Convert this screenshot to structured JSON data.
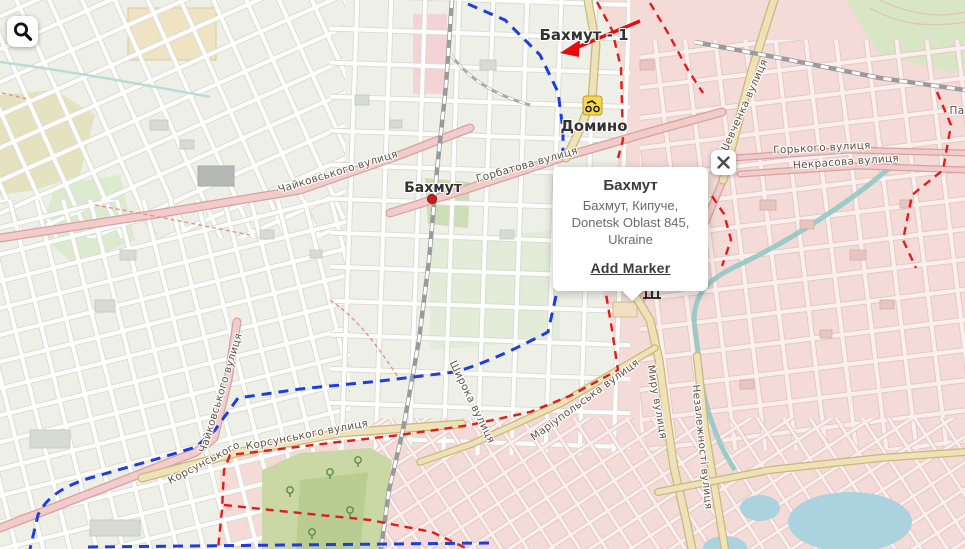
{
  "ui": {
    "search_button": {
      "icon": "magnifier"
    },
    "close_button": {
      "icon": "x"
    },
    "popup": {
      "title": "Бахмут",
      "address_lines": [
        "Бахмут, Кипуче,",
        "Donetsk Oblast 845,",
        "Ukraine"
      ],
      "action_label": "Add Marker"
    }
  },
  "map": {
    "labels": [
      {
        "kind": "place",
        "text": "Бахмут - 1",
        "x": 584,
        "y": 35,
        "rot": 0,
        "size": 15
      },
      {
        "kind": "place",
        "text": "Домино",
        "x": 594,
        "y": 126,
        "rot": 0,
        "size": 15
      },
      {
        "kind": "place",
        "text": "Бахмут",
        "x": 433,
        "y": 188,
        "rot": 0,
        "size": 14
      },
      {
        "kind": "street",
        "text": "Чайковського вулиця",
        "x": 338,
        "y": 172,
        "rot": -17
      },
      {
        "kind": "street",
        "text": "Горбатова вулиця",
        "x": 527,
        "y": 165,
        "rot": -16
      },
      {
        "kind": "street",
        "text": "Чайковського вулиця",
        "x": 221,
        "y": 393,
        "rot": -73
      },
      {
        "kind": "street",
        "text": "Корсунського вулиця",
        "x": 307,
        "y": 435,
        "rot": -11
      },
      {
        "kind": "street",
        "text": "Корсунського",
        "x": 204,
        "y": 463,
        "rot": -28
      },
      {
        "kind": "street",
        "text": "Широка вулиця",
        "x": 472,
        "y": 402,
        "rot": 64
      },
      {
        "kind": "street",
        "text": "Маріупольська вулиця",
        "x": 585,
        "y": 400,
        "rot": -36
      },
      {
        "kind": "street",
        "text": "Миру вулиця",
        "x": 657,
        "y": 402,
        "rot": 80
      },
      {
        "kind": "street",
        "text": "Незалежності вулиця",
        "x": 702,
        "y": 447,
        "rot": 84
      },
      {
        "kind": "street",
        "text": "Шевченка вулиця",
        "x": 744,
        "y": 107,
        "rot": -66
      },
      {
        "kind": "street",
        "text": "Горького вулиця",
        "x": 822,
        "y": 148,
        "rot": -3
      },
      {
        "kind": "street",
        "text": "Некрасова вулиця",
        "x": 846,
        "y": 162,
        "rot": -4
      },
      {
        "kind": "street",
        "text": "Па",
        "x": 957,
        "y": 111,
        "rot": 0
      }
    ],
    "icons": [
      {
        "name": "motorcycle-badge",
        "x": 592,
        "y": 105
      },
      {
        "name": "city-dot-marker",
        "x": 432,
        "y": 199
      },
      {
        "name": "monument-icon",
        "x": 652,
        "y": 292
      }
    ],
    "colors": {
      "land_left": "#eef0e7",
      "land_right": "#f4dbd7",
      "road_pink": "#f2cbca",
      "road_beige": "#f0e2b8",
      "route_blue": "#1d3de0",
      "boundary_red": "#e31b1b",
      "arrow_red": "#e30d0d",
      "water": "#aad3df",
      "river": "#92c9c5",
      "forest": "#c9d8a4",
      "park": "#d7e8c8"
    }
  }
}
